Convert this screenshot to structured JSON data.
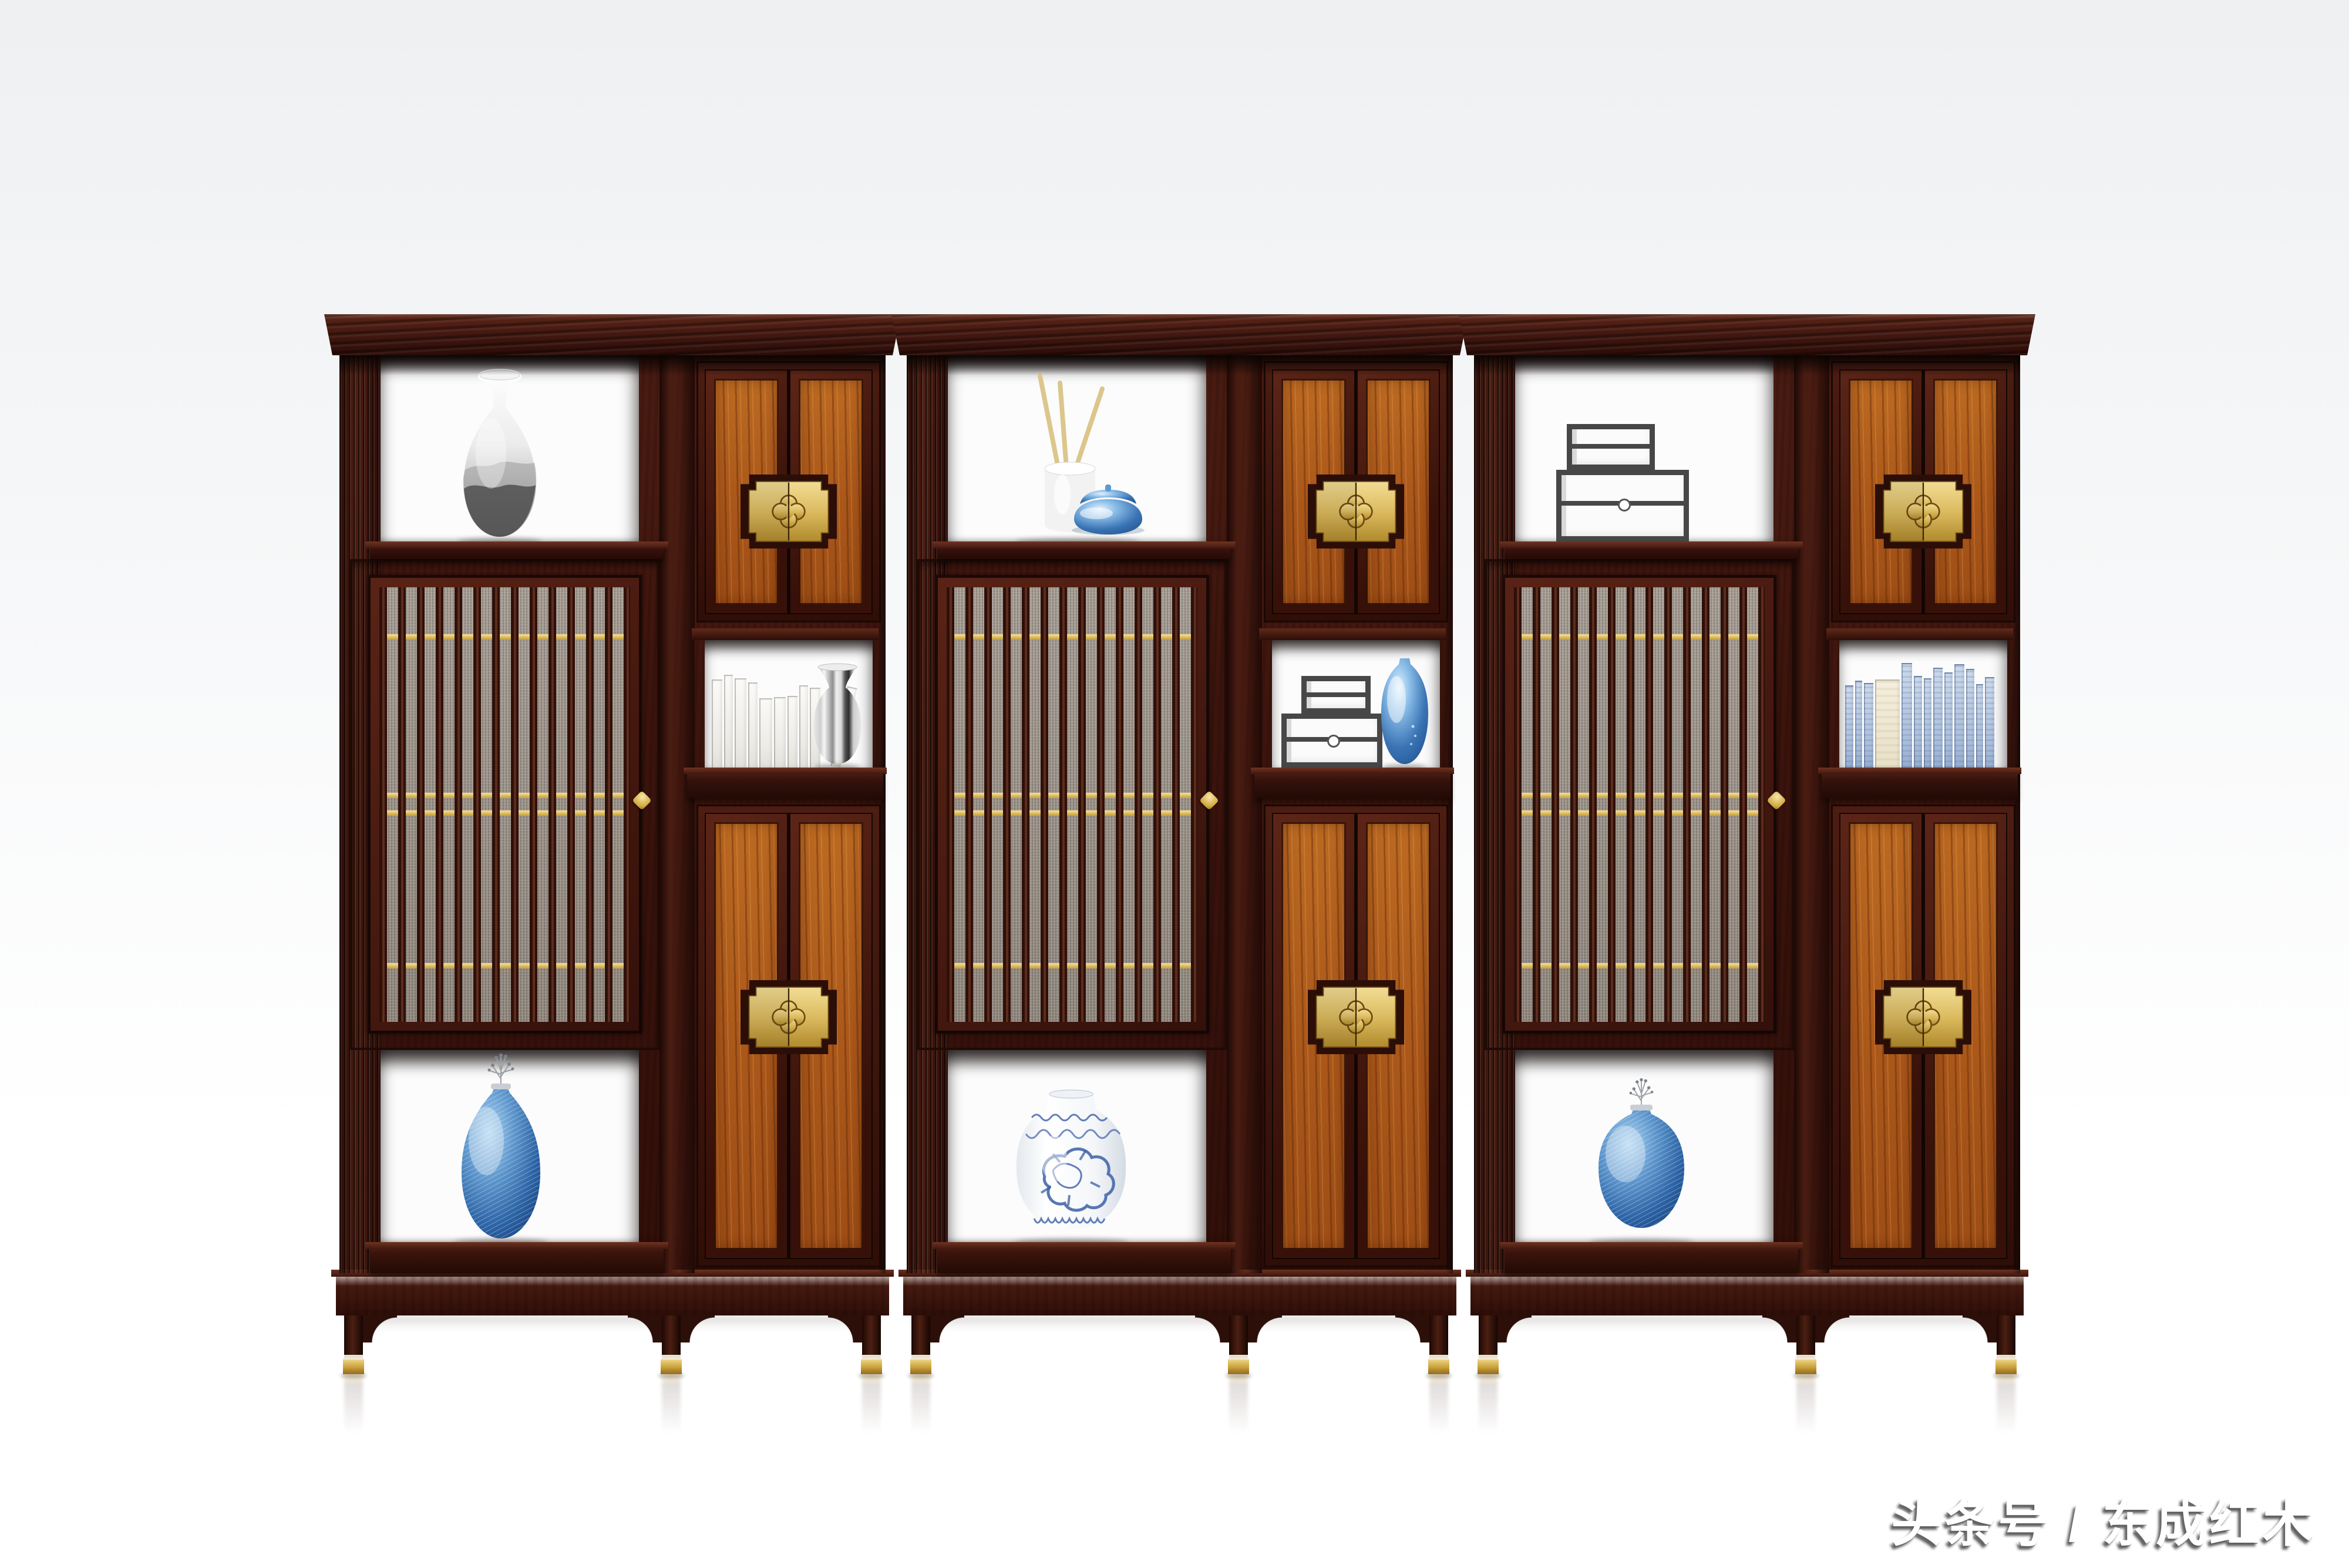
{
  "watermark": {
    "text": "头条号 / 东成红木"
  },
  "palette": {
    "bg_top": "#eef0f2",
    "bg_mid": "#f7f8f9",
    "floor": "#ffffff",
    "frame_dark": "#38110b",
    "frame_mid": "#4e1f14",
    "frame_hi": "#6a2f1e",
    "panel_wood": "#b05a1c",
    "brass": "#e6c96f",
    "mesh": "#a29a90",
    "gold_bead": "#e9cd6f",
    "blue_deep": "#173f77",
    "blue_mid": "#2f6aa8",
    "porcelain_blue": "#3c5fa6"
  },
  "scene": {
    "description": "Three-bay new-Chinese-style rosewood display bookcase set, front view on white studio background",
    "units": [
      {
        "id": "left",
        "top_niche_item": "ink-wash porcelain gourd vase",
        "lattice_door": "vertical slat door over woven mesh with gold beads and gold diamond pull",
        "upper_cabinet": "double wood doors with brass quatrefoil lock plate",
        "open_shelf_items": [
          "white books",
          "silver striped vase"
        ],
        "lower_cabinet": "double wood doors with brass quatrefoil lock plate",
        "bottom_niche_item": "blue ribbed teardrop vase with silver sprig"
      },
      {
        "id": "middle",
        "top_niche_item": "white brush pot with bamboo brushes and glossy blue lidded jar",
        "lattice_door": "vertical slat door over woven mesh with gold beads and gold diamond pull",
        "upper_cabinet": "double wood doors with brass quatrefoil lock plate",
        "open_shelf_items": [
          "stacked gray display boxes",
          "glossy blue vase"
        ],
        "lower_cabinet": "double wood doors with brass quatrefoil lock plate",
        "bottom_niche_item": "blue-and-white dragon porcelain jar"
      },
      {
        "id": "right",
        "top_niche_item": "stacked gray display boxes",
        "lattice_door": "vertical slat door over woven mesh with gold beads and gold diamond pull",
        "upper_cabinet": "double wood doors with brass quatrefoil lock plate",
        "open_shelf_items": [
          "light blue books with one cream volume"
        ],
        "lower_cabinet": "double wood doors with brass quatrefoil lock plate",
        "bottom_niche_item": "round blue ribbed vase with silver sprig"
      }
    ],
    "hardware": {
      "plate": "brass quatrefoil lock plate on stepped dark backplate",
      "feet": "brass ferrule foot caps",
      "beads": "gold beads woven into lattice"
    }
  }
}
